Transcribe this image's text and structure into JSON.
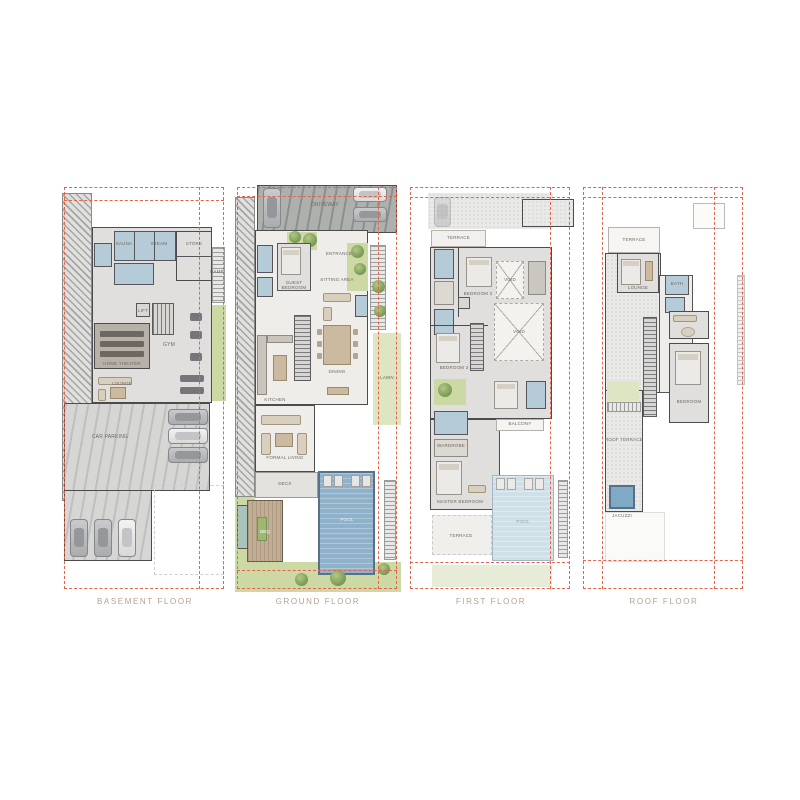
{
  "sheet": {
    "background": "#ffffff"
  },
  "colors": {
    "boundary_dash": "#e2654b",
    "wall": "#4c4c4e",
    "bath_blue": "#b5cbd7",
    "pool_blue": "#8fb2ca",
    "landscape_green": "#cdd9a5",
    "floor_label_text": "#b5a291"
  },
  "floors": [
    {
      "id": "basement",
      "label": "BASEMENT FLOOR",
      "rooms": {
        "sauna": "SAUNA",
        "steam": "STEAM",
        "store": "STORE",
        "lift": "LIFT",
        "theater": "HOME THEATER",
        "lounge": "LOUNGE",
        "gym": "GYM",
        "parking": "CAR PARKING",
        "ramp": "RAMP"
      }
    },
    {
      "id": "ground",
      "label": "GROUND FLOOR",
      "rooms": {
        "driveway": "DRIVEWAY",
        "entrance": "ENTRANCE",
        "guest": "GUEST BEDROOM",
        "sitting": "SITTING AREA",
        "dining": "DINING",
        "kitchen": "KITCHEN",
        "formal": "FORMAL LIVING",
        "deck": "DECK",
        "bbq": "BBQ",
        "pool": "POOL",
        "lawn": "LAWN"
      }
    },
    {
      "id": "first",
      "label": "FIRST FLOOR",
      "rooms": {
        "bedroom2": "BEDROOM 2",
        "bedroom3": "BEDROOM 3",
        "void1": "VOID",
        "void2": "VOID",
        "master": "MASTER BEDROOM",
        "wardrobe": "WARDROBE",
        "balcony": "BALCONY",
        "terrace": "TERRACE",
        "pool": "POOL"
      }
    },
    {
      "id": "roof",
      "label": "ROOF FLOOR",
      "rooms": {
        "terrace": "TERRACE",
        "lounge": "LOUNGE",
        "bath": "BATH",
        "bedroom": "BEDROOM",
        "roof_terrace": "ROOF TERRACE",
        "jacuzzi": "JACUZZI"
      }
    }
  ]
}
